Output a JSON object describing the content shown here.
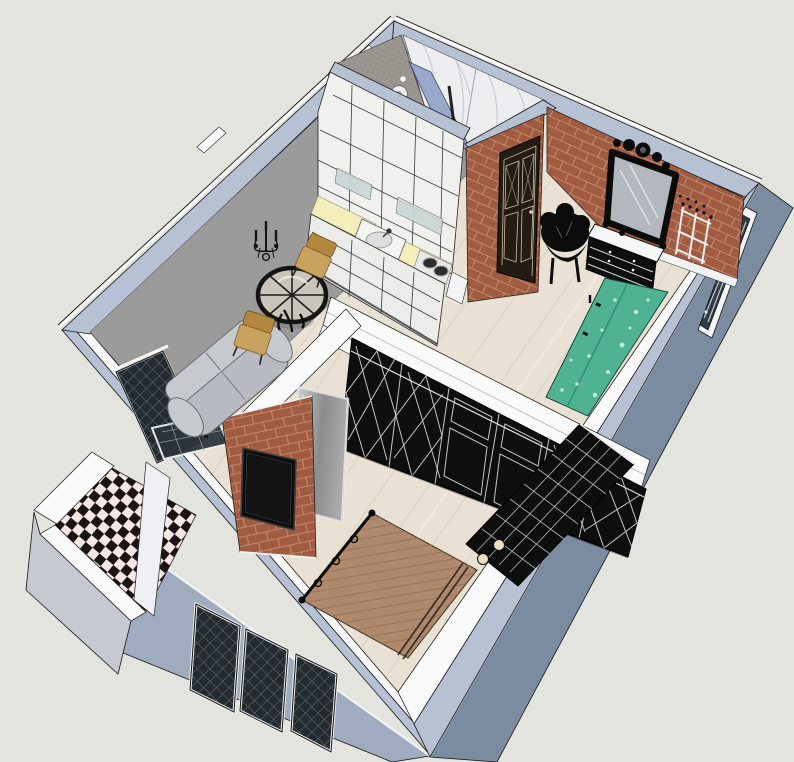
{
  "scene": {
    "kind": "3d-floorplan-cutaway-render",
    "style": "sketchup-like axonometric top-down view of a studio apartment",
    "rooms": [
      "bathroom-shower",
      "kitchen",
      "living-area",
      "entry-room",
      "bedroom",
      "balcony"
    ],
    "objects": [
      "exterior-walls",
      "shower-head",
      "glass-partition",
      "marble-wall",
      "mosaic-wall",
      "kitchen-cabinets",
      "kitchen-counter",
      "kitchen-sink",
      "cooktop",
      "bathroom-door",
      "brick-wall",
      "wall-mirror",
      "dresser",
      "side-chair",
      "coat-rack",
      "teal-bench",
      "entry-door",
      "wardrobe-row",
      "frosted-sliding-door",
      "tv-brick-wall",
      "tv",
      "bed",
      "bed-posts",
      "sofa",
      "coffee-table",
      "armchair-1",
      "armchair-2",
      "wall-sconce",
      "balcony",
      "balcony-lattice-door",
      "checker-floor",
      "lattice-windows"
    ]
  },
  "palette": {
    "bg": "#e4e4df",
    "capBlue": "#b6c2d3",
    "capWhite": "#fafafa",
    "extSE": "#7b8ca0",
    "extSW": "#9facbf",
    "balconyFace": "#c6cad0",
    "interiorWall": "#9b9b9b",
    "brick": "#a15b41",
    "brickMortar": "#c08a6e",
    "doorDark": "#241b12",
    "wood": "#e9e2d4",
    "woodStreak": "#d6cbb9",
    "bedWood": "#b08a6d",
    "bedSlat": "#96755a",
    "teal": "#4fb293",
    "tealLight": "#dff0e8",
    "counter": "#f4eebb",
    "cabinet": "#f0f0ef",
    "cabinetLine": "#3a3a3a",
    "sofa": "#b7bac0",
    "sofaBack": "#c6c9ce",
    "chairTan": "#c9a25f",
    "chairTanDark": "#b3873f",
    "blackPaint": "#0e0e0e",
    "marble": "#edeef0",
    "marbleVein": "#b9bcc6",
    "mosaic": "#9b9791",
    "mosaicLine": "#868278",
    "glassBlue": "#8fa2c8",
    "checkerDark": "#1a1414",
    "checkerLight": "#f6e7e4",
    "latticeGlass": "#232a30",
    "latticeLine": "#7d858b",
    "grayDoorA": "#d8d9da",
    "grayDoorB": "#8a8c8e",
    "mirrorGlass": "#b3b8bf",
    "outline": "#141414",
    "white": "#ffffff"
  }
}
